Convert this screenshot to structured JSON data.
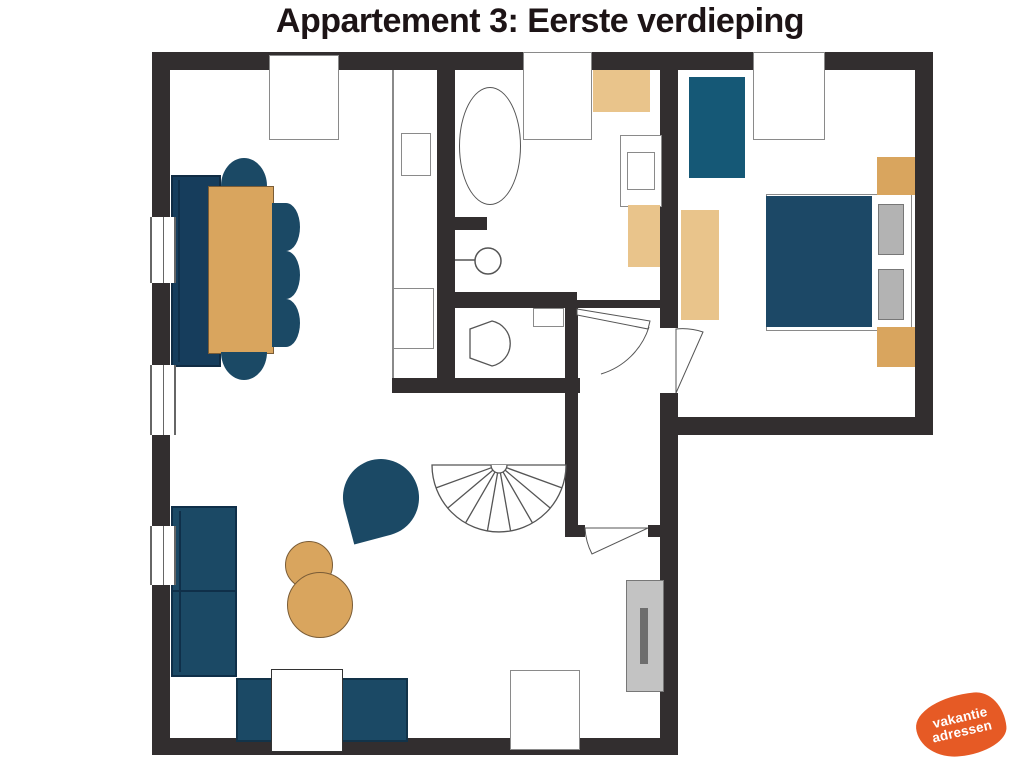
{
  "title": "Appartement 3: Eerste verdieping",
  "logo": {
    "line1": "vakantie",
    "line2": "adressen"
  },
  "colors": {
    "walls": "#322e2f",
    "furniture_blue": "#1b4965",
    "furniture_blue_dark": "#163d5c",
    "furniture_blue_bright": "#155876",
    "furniture_wood": "#d9a55e",
    "furniture_wood_light": "#e9c48b",
    "appliance_gray": "#c3c3c3",
    "outline_gray": "#666666",
    "logo_orange": "#e65a25",
    "title_color": "#1d1416"
  }
}
